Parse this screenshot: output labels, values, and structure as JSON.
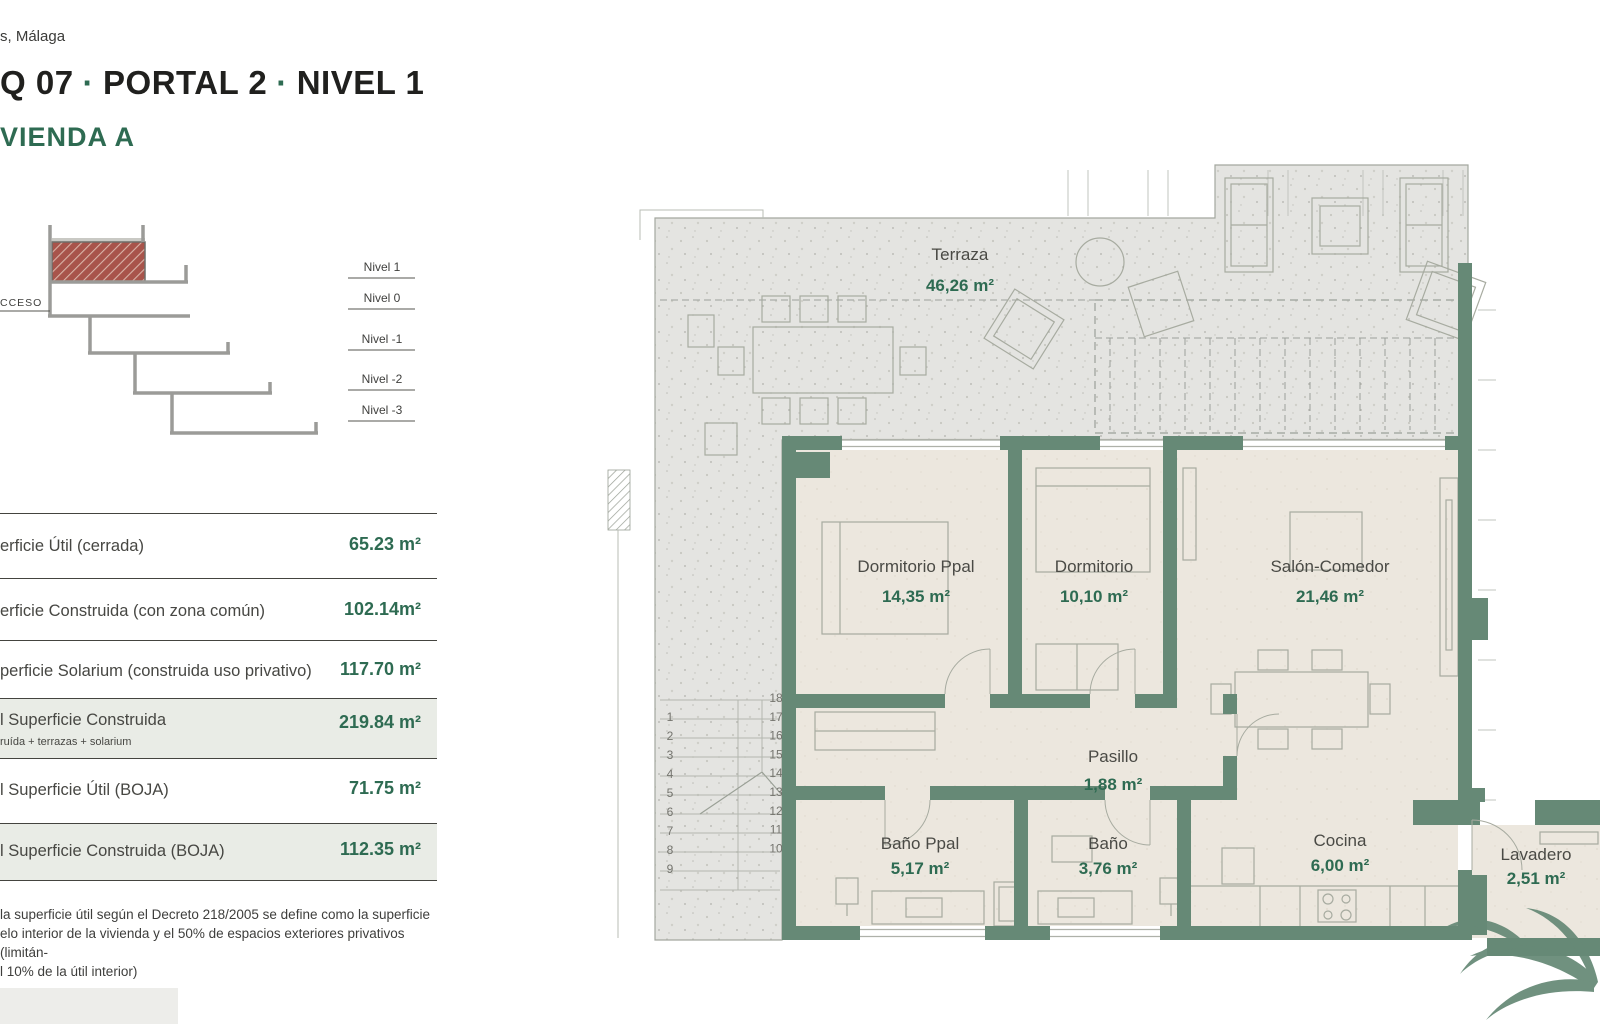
{
  "location": "s, Málaga",
  "title": {
    "part1": "Q 07",
    "dot": "·",
    "part2": "PORTAL 2",
    "part3": "NIVEL 1"
  },
  "subtitle": "VIENDA A",
  "section": {
    "acceso": "CCESO",
    "levels": [
      "Nivel 1",
      "Nivel 0",
      "Nivel -1",
      "Nivel -2",
      "Nivel -3"
    ]
  },
  "surfaces": {
    "rows": [
      {
        "label": "erficie Útil (cerrada)",
        "value": "65.23 m²",
        "highlighted": false
      },
      {
        "label": "erficie Construida (con zona común)",
        "value": "102.14m²",
        "highlighted": false
      },
      {
        "label": "perficie Solarium (construida uso privativo)",
        "value": "117.70 m²",
        "highlighted": false
      },
      {
        "label": "l Superficie Construida",
        "sub": "ruída + terrazas + solarium",
        "value": "219.84 m²",
        "highlighted": true
      },
      {
        "label": "l Superficie Útil (BOJA)",
        "value": "71.75 m²",
        "highlighted": false
      },
      {
        "label": "l Superficie Construida (BOJA)",
        "value": "112.35 m²",
        "highlighted": true
      }
    ]
  },
  "footnote": {
    "lines": [
      "la superficie útil según el Decreto 218/2005 se define como la superficie",
      "elo interior de la vivienda y el 50% de espacios exteriores privativos (limitán-",
      "l 10% de la útil interior)"
    ]
  },
  "plan": {
    "rooms": [
      {
        "id": "terraza",
        "name": "Terraza",
        "area": "46,26 m²"
      },
      {
        "id": "dormitorio-ppal",
        "name": "Dormitorio Ppal",
        "area": "14,35 m²"
      },
      {
        "id": "dormitorio",
        "name": "Dormitorio",
        "area": "10,10 m²"
      },
      {
        "id": "salon-comedor",
        "name": "Salón-Comedor",
        "area": "21,46 m²"
      },
      {
        "id": "pasillo",
        "name": "Pasillo",
        "area": "1,88 m²"
      },
      {
        "id": "bano-ppal",
        "name": "Baño Ppal",
        "area": "5,17 m²"
      },
      {
        "id": "bano",
        "name": "Baño",
        "area": "3,76 m²"
      },
      {
        "id": "cocina",
        "name": "Cocina",
        "area": "6,00 m²"
      },
      {
        "id": "lavadero",
        "name": "Lavadero",
        "area": "2,51 m²"
      }
    ],
    "stairs": {
      "left": [
        "1",
        "2",
        "3",
        "4",
        "5",
        "6",
        "7",
        "8",
        "9"
      ],
      "right": [
        "18",
        "17",
        "16",
        "15",
        "14",
        "13",
        "12",
        "11",
        "10"
      ]
    }
  },
  "colors": {
    "wall_green": "#668976",
    "accent_green": "#2e6b52",
    "terrace_gray": "#e4e4e1",
    "floor_cream": "#ece7de",
    "section_red": "#a8544b"
  }
}
